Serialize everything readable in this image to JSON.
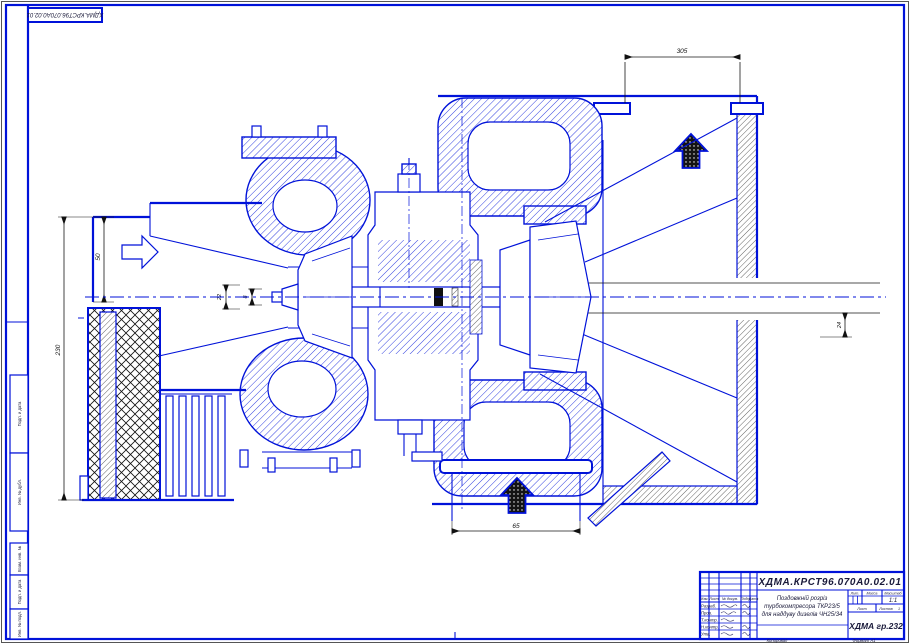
{
  "frame": {
    "corner_doc_number": "ХДМА.КРСТ96.070А0.02.01",
    "side_labels": [
      "Подп. и дата",
      "Инв. № дубл.",
      "Взам. инв. №",
      "Подп. и дата",
      "Инв. № подл."
    ]
  },
  "dimensions": {
    "top_duct_width": "305",
    "inlet_height": "50",
    "overall_height": "230",
    "hub_diameter": "22",
    "shaft_diameter": "8",
    "right_offset": "24",
    "bottom_duct_width": "65"
  },
  "title_block": {
    "doc_number": "ХДМА.КРСТ96.070А0.02.01",
    "description_line1": "Поздовжній розріз",
    "description_line2": "турбокомпресора ТКР23/5",
    "description_line3": "для наддуву дизелів ЧН25/34",
    "org_group": "ХДМА гр.232",
    "col_headers": [
      "Изм.",
      "Лист",
      "№ докум.",
      "Подп.",
      "Дата"
    ],
    "row_roles": [
      "Разраб.",
      "Пров.",
      "Т.контр.",
      "Н.контр.",
      "Утв."
    ],
    "right_headers": [
      "Лит.",
      "Масса",
      "Масштаб"
    ],
    "scale_value": "1:1",
    "sheet_label": "Лист",
    "sheets_label": "Листов",
    "sheets_value": "1",
    "footer_copied": "Копировал",
    "footer_format": "Формат A1"
  },
  "colors": {
    "line_blue": "#0012d9",
    "hatch_black": "#161616",
    "background": "#ffffff"
  }
}
